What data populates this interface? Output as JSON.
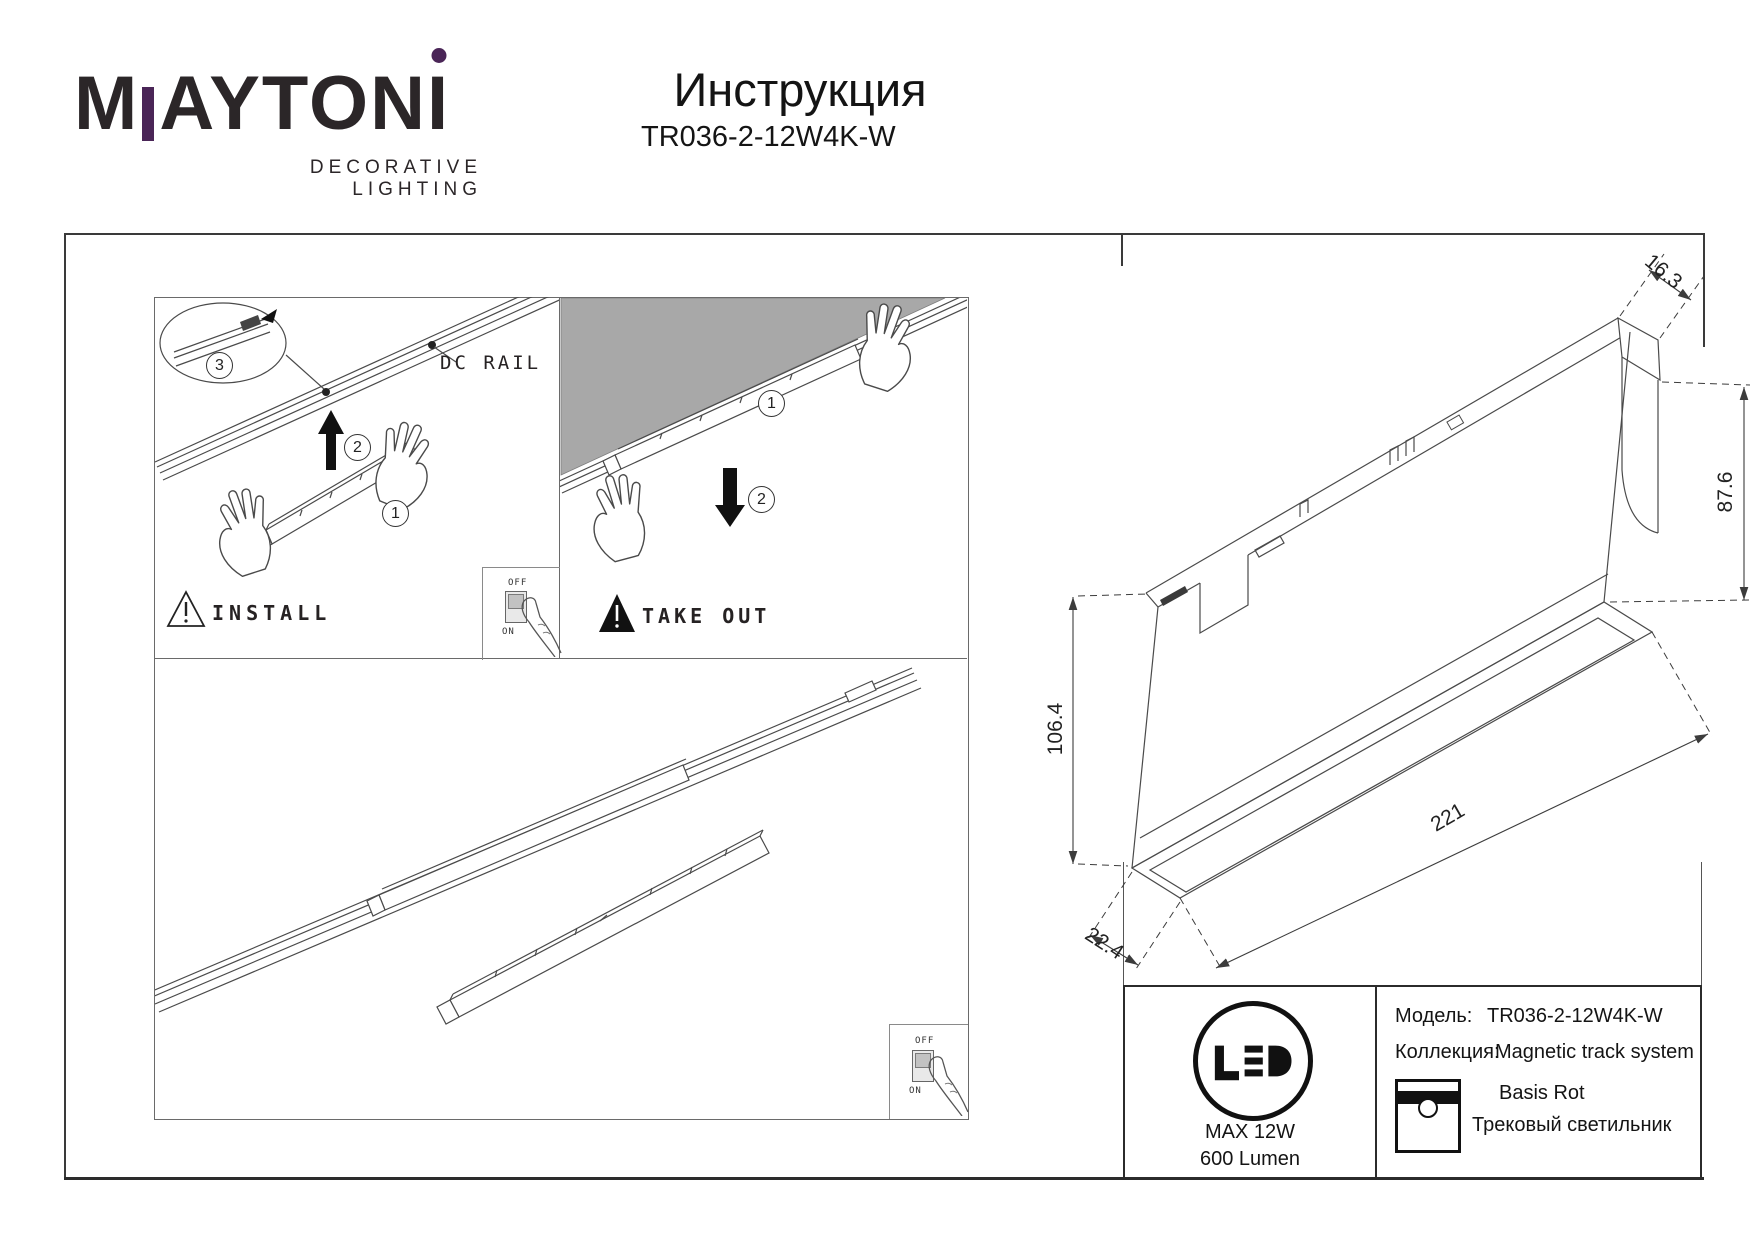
{
  "meta": {
    "accent": "#4a2557",
    "ink": "#262223",
    "ceiling_gray": "#a8a8a8"
  },
  "logo": {
    "brand": "MAYTONI",
    "part_m": "M",
    "part_mid": "AYTON",
    "part_i": "I",
    "tagline": "DECORATIVE LIGHTING"
  },
  "header": {
    "title": "Инструкция",
    "model": "TR036-2-12W4K-W"
  },
  "install_panel": {
    "caption": "INSTALL",
    "rail_label": "DC RAIL",
    "steps": {
      "s1": "1",
      "s2": "2",
      "s3": "3"
    },
    "switch_off": "OFF",
    "switch_on": "ON"
  },
  "takeout_panel": {
    "caption": "TAKE OUT",
    "steps": {
      "s1": "1",
      "s2": "2"
    }
  },
  "bottom_panel": {
    "switch_off": "OFF",
    "switch_on": "ON"
  },
  "dimensions": {
    "top_width": "16.3",
    "front_height": "87.6",
    "total_height": "106.4",
    "length": "221",
    "bottom_width": "22.4"
  },
  "spec_table": {
    "led_badge": "LED",
    "max_power": "MAX 12W",
    "luminous_flux": "600 Lumen",
    "model_label": "Модель:",
    "model_value": "TR036-2-12W4K-W",
    "collection_label": "Коллекция:",
    "collection_value": "Magnetic track system",
    "series": "Basis Rot",
    "product_type": "Трековый светильник"
  }
}
